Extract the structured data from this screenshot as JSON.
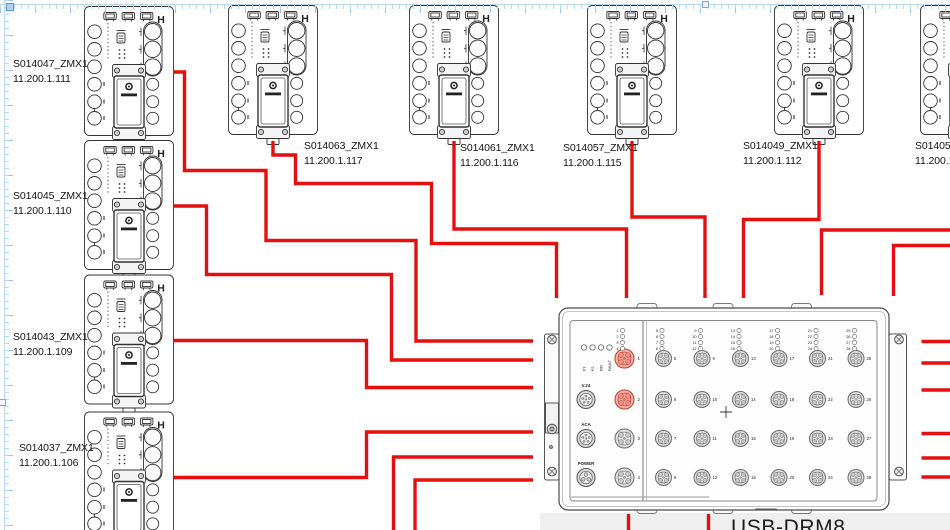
{
  "colors": {
    "cable": "#e60f0f",
    "page_guide": "#b9d8f2",
    "selection_handle": "#74abdf",
    "port_highlight": "#c0392b",
    "offpage": "#efefef"
  },
  "devices": [
    {
      "id": "S014047",
      "label": "S014047_ZMX1",
      "ip": "11.200.1.111",
      "x": 84,
      "y": 6,
      "label_x": 13,
      "label_y": 57
    },
    {
      "id": "S014045",
      "label": "S014045_ZMX1",
      "ip": "11.200.1.110",
      "x": 84,
      "y": 140,
      "label_x": 13,
      "label_y": 189
    },
    {
      "id": "S014043",
      "label": "S014043_ZMX1",
      "ip": "11.200.1.109",
      "x": 84,
      "y": 274.5,
      "label_x": 13,
      "label_y": 330
    },
    {
      "id": "S014037",
      "label": "S014037_ZMX1",
      "ip": "11.200.1.106",
      "x": 84,
      "y": 411.5,
      "label_x": 19,
      "label_y": 441
    },
    {
      "id": "S014063",
      "label": "S014063_ZMX1",
      "ip": "11.200.1.117",
      "x": 228,
      "y": 5,
      "label_x": 304,
      "label_y": 139
    },
    {
      "id": "S014061",
      "label": "S014061_ZMX1",
      "ip": "11.200.1.116",
      "x": 409,
      "y": 5,
      "label_x": 460,
      "label_y": 141
    },
    {
      "id": "S014057",
      "label": "S014057_ZMX1",
      "ip": "11.200.1.115",
      "x": 587,
      "y": 5,
      "label_x": 563,
      "label_y": 141
    },
    {
      "id": "S014049",
      "label": "S014049_ZMX1",
      "ip": "11.200.1.112",
      "x": 774,
      "y": 5,
      "label_x": 743,
      "label_y": 139
    },
    {
      "id": "S014053",
      "label": "S014053_ZMX1",
      "ip": "11.200.1.113",
      "x": 920,
      "y": 5,
      "label_x": 915,
      "label_y": 139
    }
  ],
  "hub": {
    "label": "USB-DRM8",
    "status_leds": [
      "P1",
      "P2",
      "RM",
      "FAULT"
    ],
    "aux_ports": [
      "V.24",
      "ACA",
      "POWER"
    ],
    "front_ports": [
      1,
      2,
      3,
      4
    ],
    "highlighted_ports": [
      1,
      2
    ],
    "port_columns": [
      [
        5,
        6,
        7,
        8
      ],
      [
        9,
        10,
        11,
        12
      ],
      [
        13,
        14,
        15,
        16
      ],
      [
        17,
        18,
        19,
        20
      ],
      [
        21,
        22,
        23,
        24
      ],
      [
        25,
        26,
        27,
        28
      ]
    ]
  },
  "cables": [
    {
      "from": "S014047",
      "to": "hub-left-1",
      "points": "173,72 184.5,72 184.5,170.5 266,170.5 266,240.5 416,240.5 416,341 533,341"
    },
    {
      "from": "S014045",
      "to": "hub-left-2",
      "points": "173,206 206.5,206 206.5,274.5 391.5,274.5 391.5,360 533,360"
    },
    {
      "from": "S014043",
      "to": "hub-left-3",
      "points": "173,340.5 366.5,340.5 366.5,387.5 533,387.5"
    },
    {
      "from": "S014037",
      "to": "hub-left-4",
      "points": "173,477.5 366.5,477.5 366.5,432 533,432"
    },
    {
      "from": "offscreen-bottom",
      "to": "hub-left-5",
      "points": "393.5,532 393.5,457 533,457"
    },
    {
      "from": "offscreen-bottom",
      "to": "hub-left-6",
      "points": "415,532 415,480 533,480"
    },
    {
      "from": "S014063",
      "to": "hub-top-1",
      "points": "273,141 273,155 295.5,155 295.5,183.5 431.5,183.5 431.5,243.5 556.5,243.5 556.5,298"
    },
    {
      "from": "S014061",
      "to": "hub-top-2",
      "points": "454,141 454,229 626.5,229 626.5,298"
    },
    {
      "from": "S014057",
      "to": "hub-top-3",
      "points": "632,141 632,217 705,217 705,298"
    },
    {
      "from": "S014049",
      "to": "hub-top-4",
      "points": "819,141 819,219.5 743.5,219.5 743.5,298"
    },
    {
      "from": "offscreen-right",
      "to": "hub-top-5",
      "points": "952,230 821.5,230 821.5,295"
    },
    {
      "from": "offscreen-right",
      "to": "hub-top-6",
      "points": "952,245.5 893.5,245.5 893.5,296"
    },
    {
      "from": "hub-right-1",
      "to": "offscreen-right",
      "points": "921.5,341.5 952,341.5"
    },
    {
      "from": "hub-right-2",
      "to": "offscreen-right",
      "points": "921.5,363 952,363"
    },
    {
      "from": "hub-right-3",
      "to": "offscreen-right",
      "points": "921.5,390 952,390"
    },
    {
      "from": "hub-right-4",
      "to": "offscreen-right",
      "points": "921.5,433.5 952,433.5"
    },
    {
      "from": "hub-right-5",
      "to": "offscreen-right",
      "points": "921.5,458 952,458"
    },
    {
      "from": "hub-right-6",
      "to": "offscreen-right",
      "points": "921.5,477 952,477"
    },
    {
      "from": "hub-bottom-1",
      "to": "offscreen-bottom",
      "points": "628.5,514 628.5,532"
    },
    {
      "from": "hub-bottom-2",
      "to": "offscreen-bottom",
      "points": "708.5,514 708.5,532"
    }
  ]
}
